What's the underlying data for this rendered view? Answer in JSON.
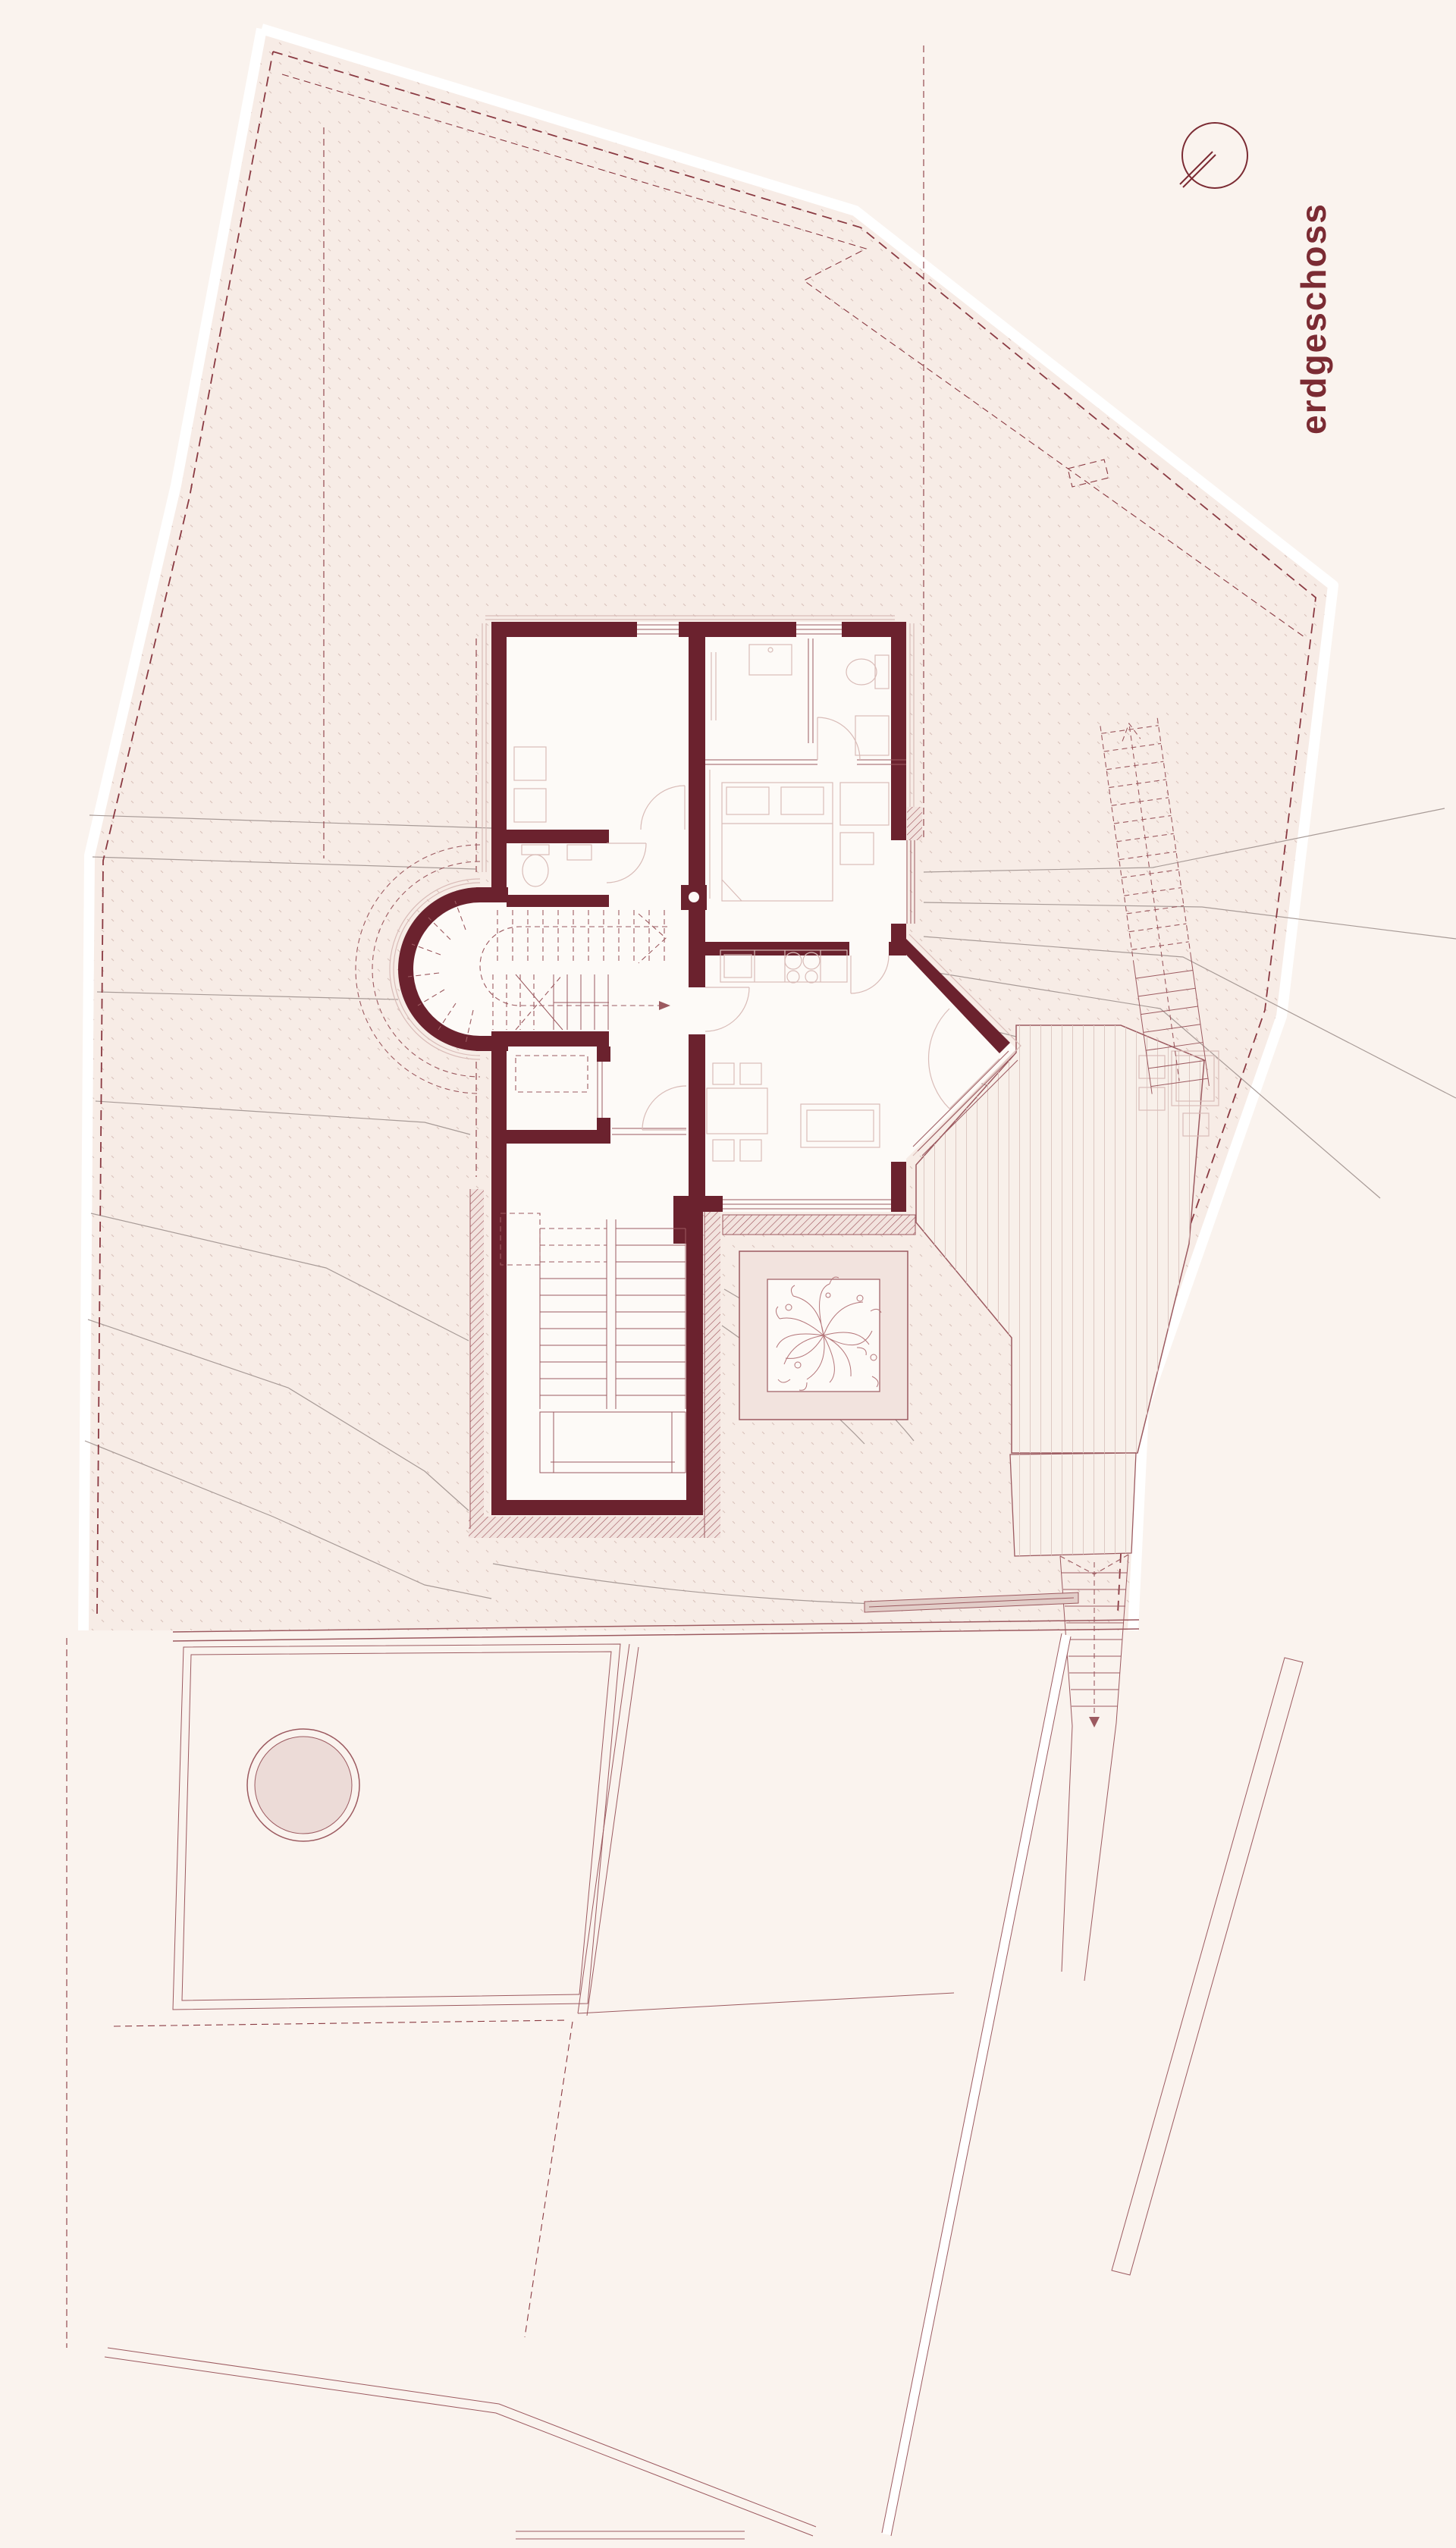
{
  "drawing": {
    "floor_label": "erdgeschoss"
  },
  "icons": {
    "north_arrow": "north-arrow-icon"
  },
  "colors": {
    "bg": "#faf3ee",
    "site": "#f7ece6",
    "dots": "#d9c2bb",
    "wall": "#6b222e",
    "room": "#fdfaf7",
    "lineLight": "#d9bcb8",
    "lineMid": "#9c5a60",
    "boundary": "#8a3a42",
    "contour": "#a89b97",
    "deckFill": "#f8f0ea",
    "plank": "#ddc8c2",
    "hatchBg": "#f2e3de",
    "hatchLine": "#9c5058",
    "accent": "#7b2b33",
    "pond": "#ecdbd7",
    "bench": "#e2cdc8",
    "tree": "#b4767a",
    "white": "#ffffff"
  }
}
